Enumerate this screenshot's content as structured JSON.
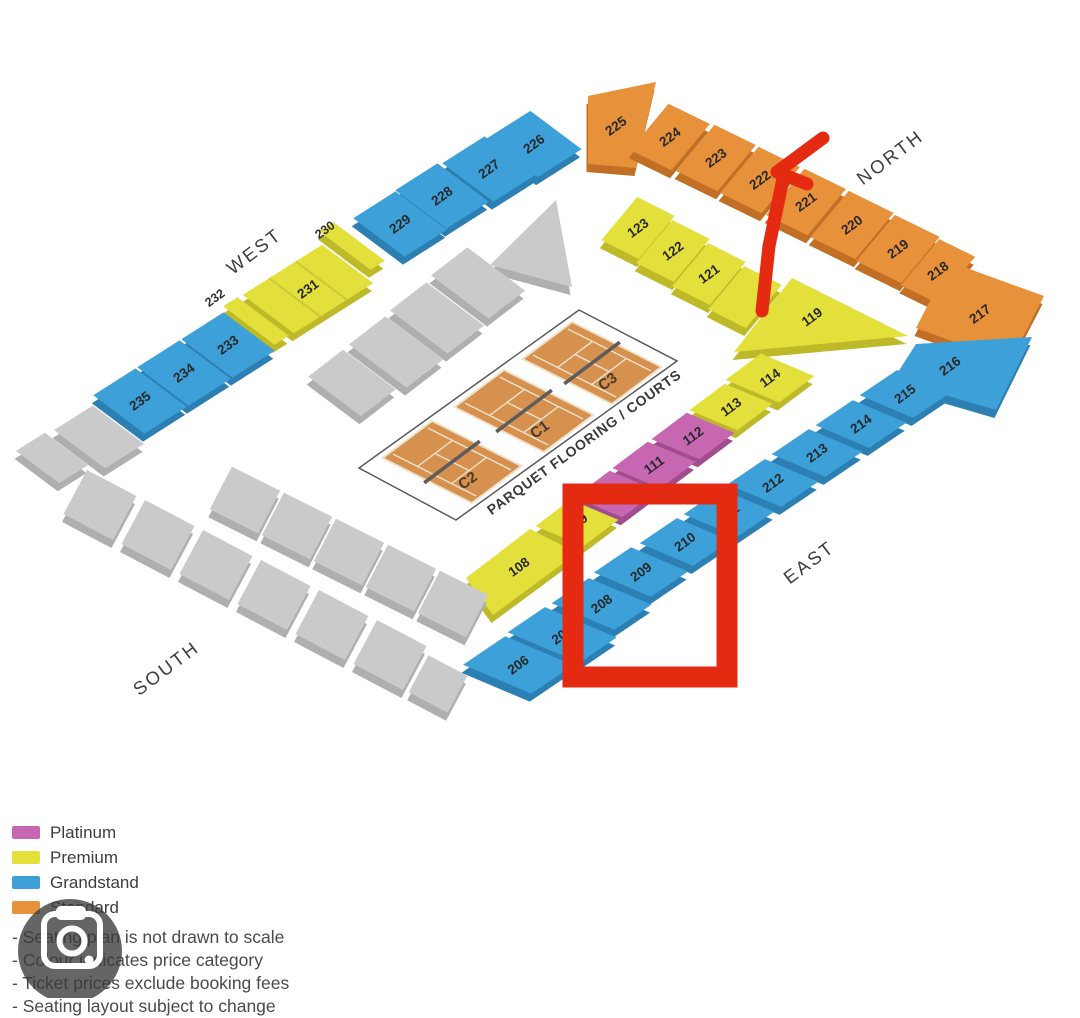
{
  "canvas": {
    "width": 1080,
    "height": 998,
    "background": "#ffffff"
  },
  "categories": {
    "platinum": {
      "label": "Platinum",
      "fill": "#C767B2",
      "side": "#A04C8E"
    },
    "premium": {
      "label": "Premium",
      "fill": "#E3DF3B",
      "side": "#BDB929"
    },
    "grandstand": {
      "label": "Grandstand",
      "fill": "#3DA0D8",
      "side": "#2B7FB3"
    },
    "standard": {
      "label": "Standard",
      "fill": "#E8913B",
      "side": "#C06F25"
    },
    "unlabeled": {
      "label": "",
      "fill": "#CACACA",
      "side": "#AFAFAF"
    }
  },
  "legend_order": [
    "platinum",
    "premium",
    "grandstand",
    "standard"
  ],
  "notes": [
    "Seating plan is not drawn to scale",
    "Colour indicates price category",
    "Ticket prices exclude booking fees",
    "Seating layout subject to change"
  ],
  "compass": [
    {
      "label": "NORTH",
      "x": 890,
      "y": 157,
      "rotation": -37
    },
    {
      "label": "EAST",
      "x": 809,
      "y": 562,
      "rotation": -37
    },
    {
      "label": "SOUTH",
      "x": 166,
      "y": 668,
      "rotation": -37
    },
    {
      "label": "WEST",
      "x": 254,
      "y": 251,
      "rotation": -37
    }
  ],
  "outer_labels": [
    {
      "text": "230",
      "x": 325,
      "y": 230
    },
    {
      "text": "232",
      "x": 215,
      "y": 298
    }
  ],
  "courts": {
    "outline": [
      [
        579,
        310
      ],
      [
        677,
        361
      ],
      [
        456,
        520
      ],
      [
        359,
        468
      ]
    ],
    "floor_label": "PARQUET FLOORING / COURTS",
    "floor_label_pos": [
      584,
      442
    ],
    "floor_label_rotation": -36,
    "court_fill": "#D6914F",
    "court_line": "#F0E3CC",
    "net_color": "#5c5c5c",
    "items": [
      {
        "label": "C3",
        "center": [
          592,
          363
        ]
      },
      {
        "label": "C1",
        "center": [
          524,
          411
        ]
      },
      {
        "label": "C2",
        "center": [
          452,
          462
        ]
      }
    ]
  },
  "sections": [
    {
      "id": "225",
      "label": "225",
      "category": "standard",
      "wall": "ne",
      "poly": [
        [
          588,
          96
        ],
        [
          656,
          82
        ],
        [
          636,
          168
        ],
        [
          588,
          164
        ]
      ],
      "label_pos": [
        616,
        126
      ]
    },
    {
      "id": "224",
      "label": "224",
      "category": "standard",
      "wall": "ne",
      "c": [
        670,
        137
      ]
    },
    {
      "id": "223",
      "label": "223",
      "category": "standard",
      "wall": "ne",
      "c": [
        716,
        158
      ]
    },
    {
      "id": "222",
      "label": "222",
      "category": "standard",
      "wall": "ne",
      "c": [
        760,
        180
      ]
    },
    {
      "id": "221",
      "label": "221",
      "category": "standard",
      "wall": "ne",
      "c": [
        806,
        202
      ]
    },
    {
      "id": "220",
      "label": "220",
      "category": "standard",
      "wall": "ne",
      "c": [
        852,
        225
      ],
      "w": 50
    },
    {
      "id": "219",
      "label": "219",
      "category": "standard",
      "wall": "ne",
      "c": [
        898,
        249
      ],
      "w": 50
    },
    {
      "id": "218",
      "label": "218",
      "category": "standard",
      "wall": "ne",
      "c": [
        938,
        271
      ],
      "w": 40
    },
    {
      "id": "217",
      "label": "217",
      "category": "standard",
      "wall": "ne",
      "poly": [
        [
          950,
          262
        ],
        [
          1044,
          296
        ],
        [
          1010,
          362
        ],
        [
          916,
          328
        ]
      ],
      "label_pos": [
        980,
        314
      ]
    },
    {
      "id": "226",
      "label": "226",
      "category": "grandstand",
      "wall": "nw",
      "c": [
        534,
        144
      ],
      "w": 52
    },
    {
      "id": "227",
      "label": "227",
      "category": "grandstand",
      "wall": "nw",
      "c": [
        489,
        169
      ]
    },
    {
      "id": "228",
      "label": "228",
      "category": "grandstand",
      "wall": "nw",
      "c": [
        442,
        196
      ]
    },
    {
      "id": "229",
      "label": "229",
      "category": "grandstand",
      "wall": "nw",
      "c": [
        400,
        224
      ]
    },
    {
      "id": "230",
      "label": null,
      "category": "premium",
      "wall": "nw",
      "c": [
        352,
        246
      ],
      "w": 17
    },
    {
      "id": "231",
      "label": "231",
      "category": "premium",
      "wall": "nw",
      "c": [
        308,
        289
      ],
      "w": 94,
      "grooves": 2
    },
    {
      "id": "232",
      "label": null,
      "category": "premium",
      "wall": "nw",
      "c": [
        256,
        321
      ],
      "w": 17
    },
    {
      "id": "233",
      "label": "233",
      "category": "grandstand",
      "wall": "nw",
      "c": [
        228,
        345
      ]
    },
    {
      "id": "234",
      "label": "234",
      "category": "grandstand",
      "wall": "nw",
      "c": [
        184,
        373
      ]
    },
    {
      "id": "235",
      "label": "235",
      "category": "grandstand",
      "wall": "nw",
      "c": [
        140,
        401
      ]
    },
    {
      "id": "gray-w1",
      "label": null,
      "category": "unlabeled",
      "wall": "nw",
      "c": [
        99,
        437
      ],
      "w": 46
    },
    {
      "id": "gray-w2",
      "label": null,
      "category": "unlabeled",
      "wall": "nw",
      "c": [
        52,
        458
      ],
      "w": 34,
      "d": 54
    },
    {
      "id": "216",
      "label": "216",
      "category": "grandstand",
      "wall": "se",
      "poly": [
        [
          916,
          344
        ],
        [
          1032,
          337
        ],
        [
          996,
          410
        ],
        [
          893,
          380
        ]
      ],
      "label_pos": [
        950,
        366
      ]
    },
    {
      "id": "215",
      "label": "215",
      "category": "grandstand",
      "wall": "se",
      "c": [
        905,
        394
      ]
    },
    {
      "id": "214",
      "label": "214",
      "category": "grandstand",
      "wall": "se",
      "c": [
        861,
        424
      ]
    },
    {
      "id": "213",
      "label": "213",
      "category": "grandstand",
      "wall": "se",
      "c": [
        817,
        453
      ]
    },
    {
      "id": "212",
      "label": "212",
      "category": "grandstand",
      "wall": "se",
      "c": [
        773,
        483
      ]
    },
    {
      "id": "211",
      "label": "211",
      "category": "grandstand",
      "wall": "se",
      "c": [
        729,
        513
      ]
    },
    {
      "id": "210",
      "label": "210",
      "category": "grandstand",
      "wall": "se",
      "c": [
        685,
        542
      ]
    },
    {
      "id": "209",
      "label": "209",
      "category": "grandstand",
      "wall": "se",
      "c": [
        641,
        572
      ],
      "d": 62
    },
    {
      "id": "208",
      "label": "208",
      "category": "grandstand",
      "wall": "se",
      "c": [
        597,
        602
      ],
      "d": 68,
      "vs": -5
    },
    {
      "id": "207",
      "label": "207",
      "category": "grandstand",
      "wall": "se",
      "c": [
        553,
        631
      ],
      "d": 78,
      "vs": -10
    },
    {
      "id": "206",
      "label": "206",
      "category": "grandstand",
      "wall": "se",
      "c": [
        509,
        661
      ],
      "w": 52,
      "d": 74,
      "vs": -10
    },
    {
      "id": "123",
      "label": "123",
      "category": "premium",
      "wall": "inne",
      "c": [
        638,
        228
      ]
    },
    {
      "id": "122",
      "label": "122",
      "category": "premium",
      "wall": "inne",
      "c": [
        673,
        251
      ]
    },
    {
      "id": "121",
      "label": "121",
      "category": "premium",
      "wall": "inne",
      "c": [
        709,
        274
      ]
    },
    {
      "id": "120",
      "label": null,
      "category": "premium",
      "wall": "inne",
      "c": [
        745,
        297
      ]
    },
    {
      "id": "119",
      "label": "119",
      "category": "premium",
      "wall": "inne",
      "poly": [
        [
          792,
          278
        ],
        [
          908,
          336
        ],
        [
          734,
          352
        ]
      ],
      "label_pos": [
        812,
        317
      ]
    },
    {
      "id": "114",
      "label": "114",
      "category": "premium",
      "wall": "inse",
      "c": [
        770,
        378
      ],
      "d": 58
    },
    {
      "id": "113",
      "label": "113",
      "category": "premium",
      "wall": "inse",
      "c": [
        731,
        407
      ]
    },
    {
      "id": "112",
      "label": "112",
      "category": "platinum",
      "wall": "inse",
      "c": [
        693,
        436
      ]
    },
    {
      "id": "111",
      "label": "111",
      "category": "platinum",
      "wall": "inse",
      "c": [
        654,
        465
      ]
    },
    {
      "id": "110",
      "label": null,
      "category": "platinum",
      "wall": "inse",
      "c": [
        616,
        494
      ]
    },
    {
      "id": "109",
      "label": "109",
      "category": "premium",
      "wall": "inse",
      "c": [
        577,
        523
      ]
    },
    {
      "id": "108",
      "label": "108",
      "category": "premium",
      "wall": "inse",
      "poly": [
        [
          577,
          553
        ],
        [
          493,
          615
        ],
        [
          466,
          578
        ],
        [
          530,
          529
        ]
      ],
      "label_pos": [
        519,
        567
      ]
    },
    {
      "id": "in-nw-1",
      "label": null,
      "category": "unlabeled",
      "wall": "innw",
      "poly": [
        [
          556,
          200
        ],
        [
          572,
          287
        ],
        [
          490,
          265
        ]
      ]
    },
    {
      "id": "in-nw-2",
      "label": null,
      "category": "unlabeled",
      "wall": "innw",
      "c": [
        478,
        283
      ],
      "w": 46,
      "d": 72
    },
    {
      "id": "in-nw-3",
      "label": null,
      "category": "unlabeled",
      "wall": "innw",
      "c": [
        437,
        318
      ],
      "w": 46,
      "d": 72
    },
    {
      "id": "in-nw-4",
      "label": null,
      "category": "unlabeled",
      "wall": "innw",
      "c": [
        396,
        352
      ],
      "w": 46,
      "d": 72
    },
    {
      "id": "in-nw-5",
      "label": null,
      "category": "unlabeled",
      "wall": "innw",
      "c": [
        352,
        383
      ],
      "w": 44,
      "d": 66
    },
    {
      "id": "in-sw-1",
      "label": null,
      "category": "unlabeled",
      "wall": "insw",
      "c": [
        245,
        500
      ]
    },
    {
      "id": "in-sw-2",
      "label": null,
      "category": "unlabeled",
      "wall": "insw",
      "c": [
        297,
        526
      ]
    },
    {
      "id": "in-sw-3",
      "label": null,
      "category": "unlabeled",
      "wall": "insw",
      "c": [
        349,
        552
      ]
    },
    {
      "id": "in-sw-4",
      "label": null,
      "category": "unlabeled",
      "wall": "insw",
      "c": [
        401,
        578
      ]
    },
    {
      "id": "in-sw-5",
      "label": null,
      "category": "unlabeled",
      "wall": "insw",
      "c": [
        453,
        604
      ]
    },
    {
      "id": "sw-1",
      "label": null,
      "category": "unlabeled",
      "wall": "sw",
      "c": [
        100,
        505
      ]
    },
    {
      "id": "sw-2",
      "label": null,
      "category": "unlabeled",
      "wall": "sw",
      "c": [
        158,
        535
      ]
    },
    {
      "id": "sw-3",
      "label": null,
      "category": "unlabeled",
      "wall": "sw",
      "c": [
        216,
        565
      ]
    },
    {
      "id": "sw-4",
      "label": null,
      "category": "unlabeled",
      "wall": "sw",
      "c": [
        274,
        595
      ]
    },
    {
      "id": "sw-5",
      "label": null,
      "category": "unlabeled",
      "wall": "sw",
      "c": [
        332,
        625
      ]
    },
    {
      "id": "sw-6",
      "label": null,
      "category": "unlabeled",
      "wall": "sw",
      "c": [
        390,
        655
      ]
    },
    {
      "id": "sw-7",
      "label": null,
      "category": "unlabeled",
      "wall": "sw",
      "c": [
        438,
        684
      ],
      "w": 44,
      "d": 42
    }
  ],
  "annotations": {
    "color": "#E42A10",
    "box": {
      "x": 573,
      "y": 494,
      "w": 154,
      "h": 183,
      "stroke_w": 21
    },
    "arrow": {
      "stem": [
        [
          762,
          311
        ],
        [
          769,
          246
        ],
        [
          784,
          174
        ]
      ],
      "head": [
        [
          [
            777,
            172
          ],
          [
            823,
            138
          ]
        ],
        [
          [
            777,
            172
          ],
          [
            807,
            184
          ]
        ]
      ],
      "stroke_w": 13
    }
  },
  "camera_overlay": {
    "circle_fill": "#3a3a3a",
    "circle_opacity": 0.78
  }
}
